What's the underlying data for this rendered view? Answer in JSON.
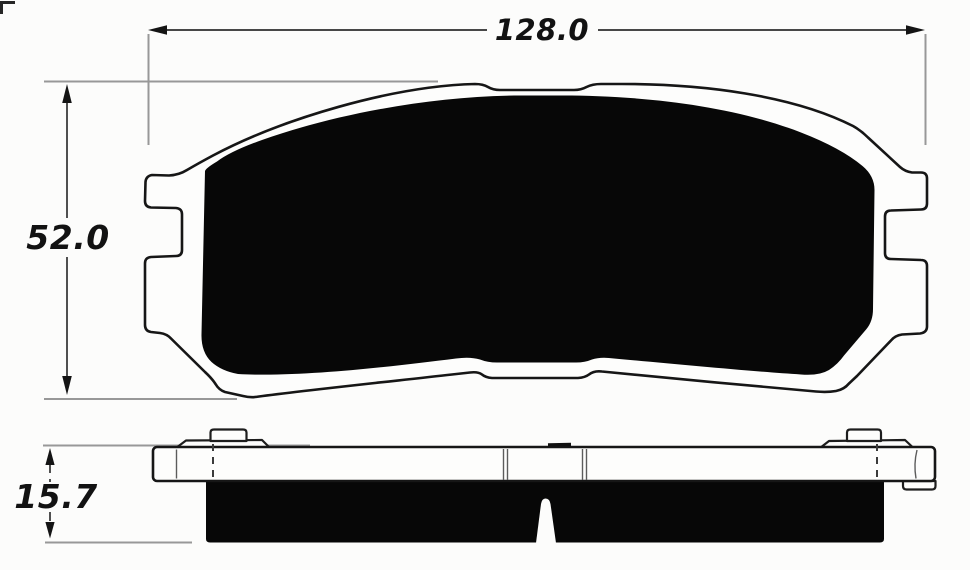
{
  "diagram": {
    "dimensions": {
      "width": {
        "label": "128.0"
      },
      "height": {
        "label": "52.0"
      },
      "thickness": {
        "label": "15.7"
      }
    },
    "views": {
      "front": {
        "parts": [
          "backing-plate-outline",
          "friction-material",
          "left-abutment-tabs",
          "right-abutment-tabs",
          "top-center-notch",
          "bottom-center-notch"
        ]
      },
      "side": {
        "parts": [
          "backing-plate",
          "left-shim-clip",
          "right-shim-clip",
          "friction-material",
          "center-wear-slot",
          "hidden-lines",
          "rivet-marks"
        ]
      }
    },
    "colors": {
      "background": "#fcfcfb",
      "outline": "#161616",
      "fill": "#070707",
      "dimension_line": "#474747",
      "extension_line": "#989898",
      "text": "#121212"
    }
  }
}
